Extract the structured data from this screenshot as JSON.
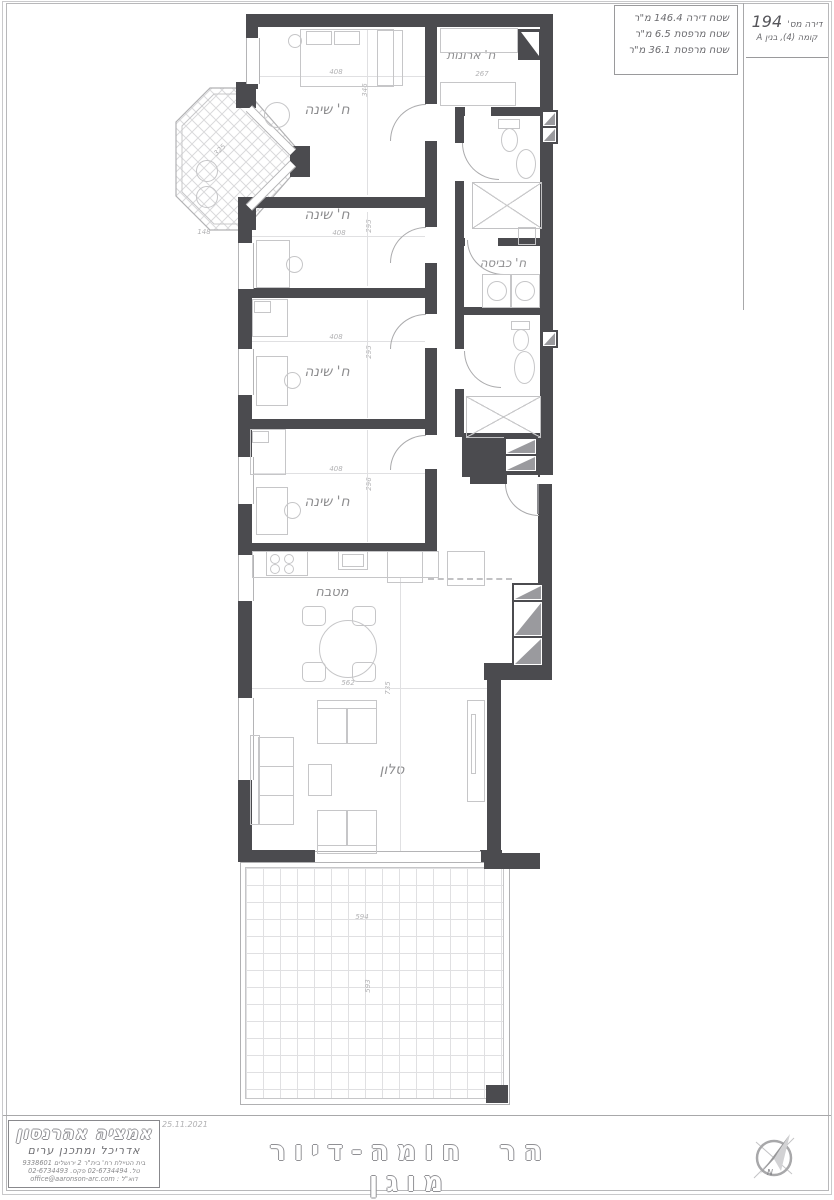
{
  "sheet": {
    "title_block": {
      "area_lines": [
        "שטח דירה 146.4 מ\"ר",
        "שטח מרפסת 6.5 מ\"ר",
        "שטח מרפסת 36.1 מ\"ר"
      ],
      "apartment_label": "דירה מס'",
      "apartment_number": "194",
      "floor_line": "קומה (4), בנין A"
    },
    "footer": {
      "architect_name": "אמציה אהרנסון",
      "architect_role": "אדריכל ומתכנן ערים",
      "address_line": "בית הטיילת רח' בית\"ר 2 ירושלים 9338601",
      "phone_line": "טל. 02-6734494 פקס. 02-6734493",
      "email_line": "דוא\"ל : office@aaronson-arc.com",
      "date": "25.11.2021",
      "project_title": "הר חומה-דיור מוגן",
      "compass_letter": "N"
    }
  },
  "plan": {
    "room_labels": {
      "bedroom": "ח' שינה",
      "closet": "ח' ארונות",
      "laundry": "ח' כביסה",
      "kitchen": "מטבח",
      "living": "סלון"
    },
    "dimensions": {
      "bedroom1_width": "408",
      "bedroom1_depth": "346",
      "closet_width": "267",
      "bedroom2_width": "408",
      "bedroom2_depth": "295",
      "bedroom3_width": "408",
      "bedroom3_depth": "295",
      "bedroom4_width": "408",
      "bedroom4_depth": "296",
      "dining_width": "562",
      "living_depth": "735",
      "balcony_width": "594",
      "balcony_depth": "593",
      "bay_width": "148",
      "bay_depth": "325"
    },
    "colors": {
      "wall": "#4b4b4f",
      "furniture_line": "#c6c6c8",
      "label_text": "#8e8e90",
      "dim_text": "#b2b2b4"
    }
  }
}
